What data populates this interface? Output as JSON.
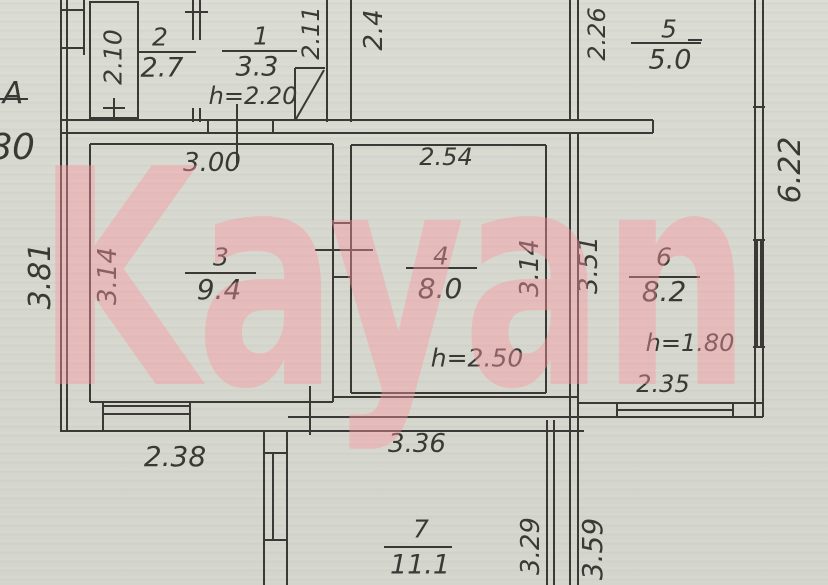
{
  "watermark": {
    "text": "Kayan"
  },
  "colors": {
    "paper": "#d7d9d0",
    "ink": "#3a3935",
    "watermark_pink": "#fb96a0"
  },
  "axis": {
    "letter": "A",
    "clipped_dimension": "80"
  },
  "rooms": {
    "r1": {
      "number": "1",
      "area": "3.3",
      "height": "h=2.20"
    },
    "r2": {
      "number": "2",
      "area": "2.7"
    },
    "r3": {
      "number": "3",
      "area": "9.4"
    },
    "r4": {
      "number": "4",
      "area": "8.0",
      "height": "h=2.50"
    },
    "r5": {
      "number": "5",
      "area": "5.0"
    },
    "r6": {
      "number": "6",
      "area": "8.2",
      "height": "h=1.80"
    },
    "r7": {
      "number": "7",
      "area": "11.1"
    }
  },
  "dims": {
    "v210": "2.10",
    "v211": "2.11",
    "v24": "2.4",
    "v226": "2.26",
    "v622": "6.22",
    "v381": "3.81",
    "v314_room3": "3.14",
    "v314_room4": "3.14",
    "v351": "3.51",
    "v329": "3.29",
    "v359": "3.59",
    "h300": "3.00",
    "h254": "2.54",
    "h235": "2.35",
    "h238": "2.38",
    "h336": "3.36"
  }
}
